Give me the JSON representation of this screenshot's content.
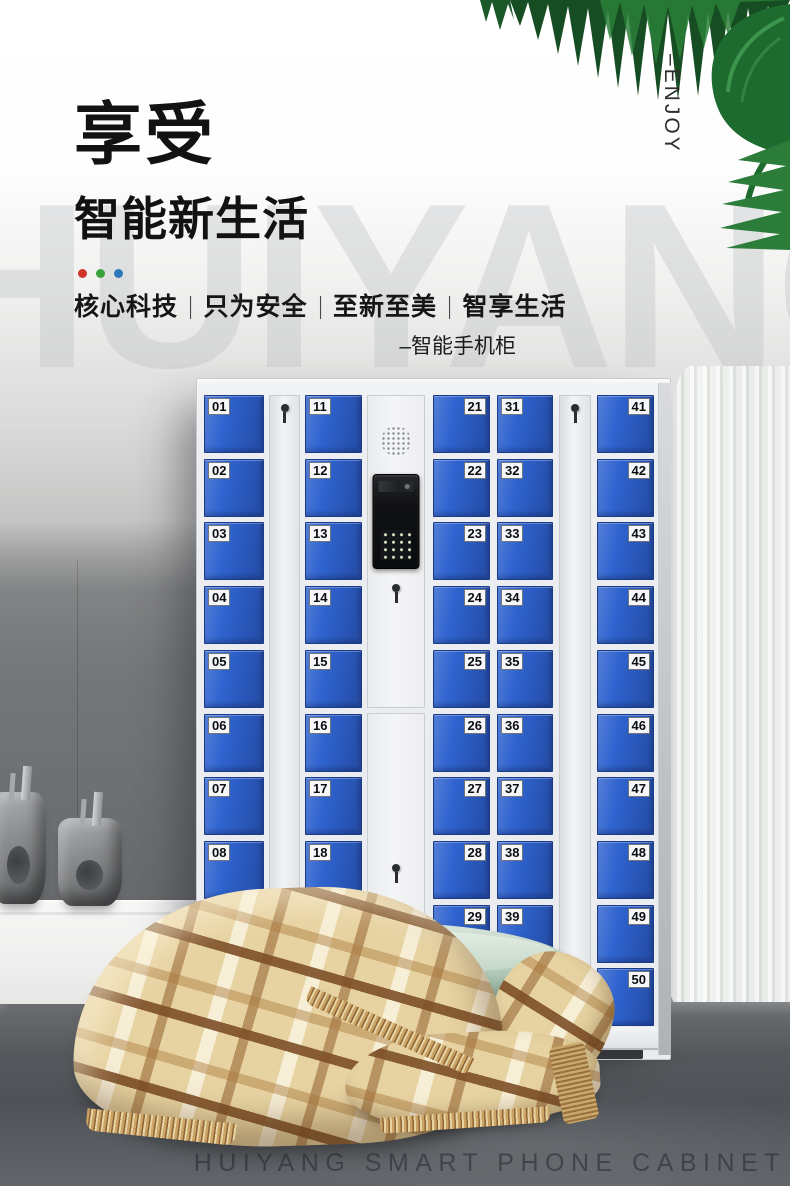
{
  "header": {
    "title": "享受",
    "subtitle": "智能新生活",
    "accent_dots": [
      "#d0352b",
      "#3aa23c",
      "#2d78b8"
    ],
    "tagline": [
      "核心科技",
      "只为安全",
      "至新至美",
      "智享生活"
    ],
    "tagline_divider": "|",
    "product_note": "–智能手机柜",
    "side_label": "–ENJOY"
  },
  "watermark": "HUIYANG",
  "cabinet": {
    "door_color": "#2f63cf",
    "door_columns": [
      {
        "label_side": "left",
        "numbers": [
          "01",
          "02",
          "03",
          "04",
          "05",
          "06",
          "07",
          "08",
          "09",
          "10"
        ]
      },
      {
        "label_side": "left",
        "numbers": [
          "11",
          "12",
          "13",
          "14",
          "15",
          "16",
          "17",
          "18",
          "19",
          "20"
        ]
      },
      {
        "label_side": "right",
        "numbers": [
          "21",
          "22",
          "23",
          "24",
          "25",
          "26",
          "27",
          "28",
          "29",
          "30"
        ]
      },
      {
        "label_side": "left",
        "numbers": [
          "31",
          "32",
          "33",
          "34",
          "35",
          "36",
          "37",
          "38",
          "39",
          "40"
        ]
      },
      {
        "label_side": "right",
        "numbers": [
          "41",
          "42",
          "43",
          "44",
          "45",
          "46",
          "47",
          "48",
          "49",
          "50"
        ]
      }
    ],
    "icons": {
      "speaker": "speaker-grille-icon",
      "camera": "camera-slot-icon",
      "keypad": "keypad-icon",
      "keyhole": "keyhole-icon"
    }
  },
  "footer": {
    "caption": "HUIYANG SMART PHONE CABINET"
  }
}
